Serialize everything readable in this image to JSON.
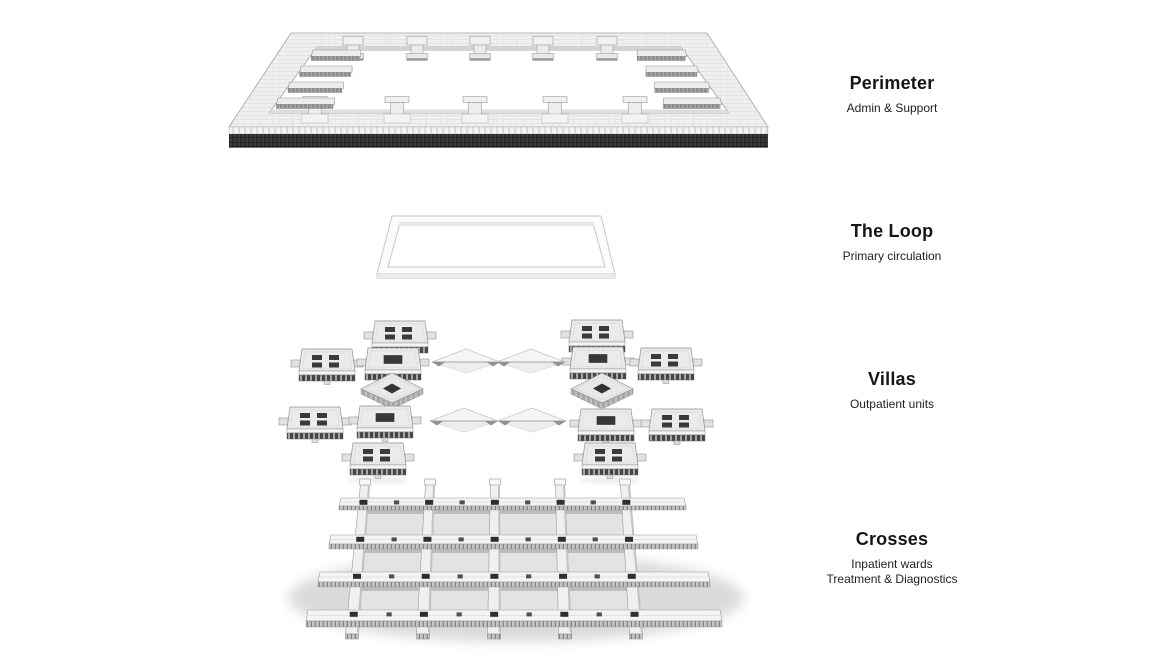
{
  "layers": [
    {
      "name": "perimeter",
      "title": "Perimeter",
      "subtitles": [
        "Admin & Support"
      ]
    },
    {
      "name": "loop",
      "title": "The Loop",
      "subtitles": [
        "Primary circulation"
      ]
    },
    {
      "name": "villas",
      "title": "Villas",
      "subtitles": [
        "Outpatient units"
      ]
    },
    {
      "name": "crosses",
      "title": "Crosses",
      "subtitles": [
        "Inpatient wards",
        "Treatment & Diagnostics"
      ]
    }
  ],
  "colors": {
    "background": "#ffffff",
    "text": "#161616",
    "facade_dark_band": "#2d2d2d",
    "model_light": "#f0f0f0",
    "roof_opening_dark": "#3a3a3a"
  }
}
